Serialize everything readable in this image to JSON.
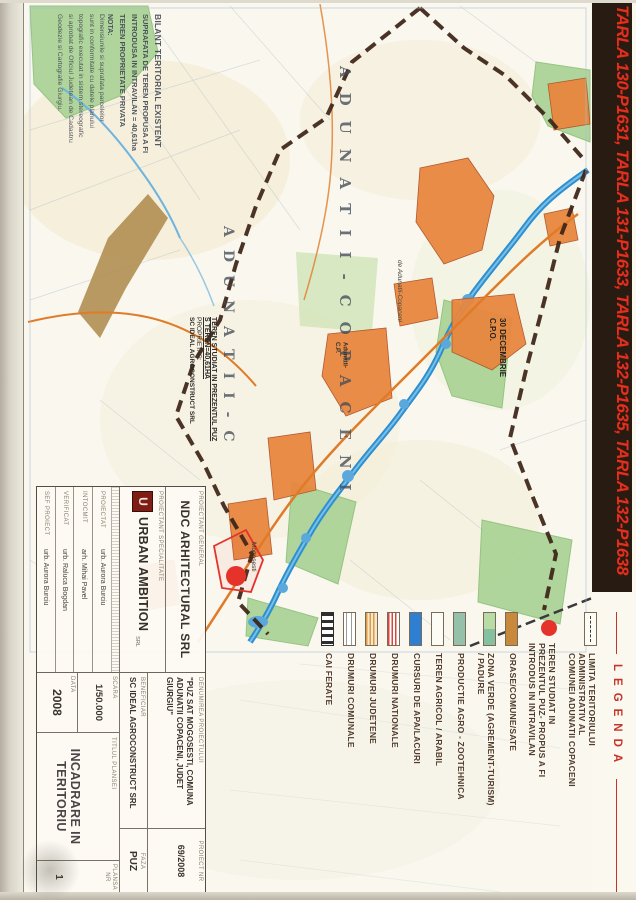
{
  "colors": {
    "banner_bg": "#281c12",
    "banner_text": "#e0301e",
    "legend_title_red": "#c5342a",
    "legend_text": "#503b2c",
    "map_paper": "#faf8ef",
    "river_blue": "#2e8fd0",
    "village_orange": "#e8873f",
    "boundary_brown": "#3c2316",
    "site_red": "#e5322a",
    "forest_green": "#a9d294"
  },
  "banner": {
    "text": "TARLA 130-P1631, TARLA 131-P1633, TARLA 132-P1635, TARLA 132-P1638"
  },
  "bilant": {
    "title": "BILANT TERITORIAL EXISTENT",
    "lines": [
      "SUPRAFATA DE TEREN PROPUSA A FI",
      "INTRODUSA IN INTRAVILAN = 40,61ha",
      "TEREN PROPRIETATE PRIVATA"
    ],
    "nota_title": "NOTA:",
    "nota_lines": [
      "Dimensiunile si suprafata parcelelor",
      "sunt in conformitate cu datele planului",
      "topografic executat in sistem stereografic",
      "si aprobat de Oficiul Judetean de Cadastru",
      "Geodezie si Cartografie Giurgiu."
    ]
  },
  "site_note": {
    "line1": "TEREN STUDIAT IN PREZENTUL PUZ",
    "line2": "S TEREN=40,61HA",
    "line3": "PROPRIETAR:",
    "line4": "SC IDEAL AGROCONSTRUCT SRL"
  },
  "map_labels": {
    "spread_name_1": "ADUNATII-COPACENI",
    "spread_name_2": "ADUNATII-C",
    "village_30dec": "30 DECEMBRIE",
    "village_30dec_sub": "C.P.O.",
    "road_label": "de Adunatii-Copaceni",
    "village_adunatii": "Adunatii-",
    "village_adunatii_sub": "C.P.",
    "village_mogosesti": "Mogosesti"
  },
  "legend": {
    "title": "LEGENDA",
    "items": [
      {
        "symbol": "administrative-boundary",
        "lines": [
          "LIMITA TERITORIULUI",
          "ADMINISTRATIV AL",
          "COMUNEI ADUNATII COPACENI"
        ]
      },
      {
        "symbol": "studied-land-circle",
        "lines": [
          "TEREN STUDIAT IN",
          "PREZENTUL PUZ- PROPUS A FI",
          "INTRODUS IN INTRAVILAN"
        ]
      },
      {
        "symbol": "built-up-area",
        "lines": [
          "ORASE/COMUNE/SATE"
        ]
      },
      {
        "symbol": "green-zone",
        "lines": [
          "ZONA VERDE (AGREMENT-TURISM)",
          "/ PADURE"
        ]
      },
      {
        "symbol": "agro-zootechnical",
        "lines": [
          "PRODUCTIE AGRO - ZOOTEHNICA"
        ]
      },
      {
        "symbol": "agricultural-land",
        "lines": [
          "TEREN AGRICOL / ARABIL"
        ]
      },
      {
        "symbol": "water-courses",
        "lines": [
          "CURSURI DE APA/LACURI"
        ]
      },
      {
        "symbol": "national-roads",
        "lines": [
          "DRUMURI NATIONALE"
        ]
      },
      {
        "symbol": "county-roads",
        "lines": [
          "DRUMURI JUDETENE"
        ]
      },
      {
        "symbol": "communal-roads",
        "lines": [
          "DRUMURI COMUNALE"
        ]
      },
      {
        "symbol": "railways",
        "lines": [
          "CAI FERATE"
        ]
      }
    ]
  },
  "title_block": {
    "proiectant_general_label": "PROIECTANT GENERAL",
    "proiectant_general": "NDC ARHITECTURAL SRL",
    "proiectant_spec_label": "PROIECTANT SPECIALITATE",
    "proiectant_spec": "URBAN AMBITION",
    "proiectant_spec_suffix": "SRL",
    "logo_letter": "U",
    "signers": [
      {
        "label": "PROIECTAT",
        "name": "urb. Aurora Burciu"
      },
      {
        "label": "INTOCMIT",
        "name": "arh. Mihai Pavel"
      },
      {
        "label": "VERIFICAT",
        "name": "urb. Raluca Bogdan"
      },
      {
        "label": "SEF PROIECT",
        "name": "urb. Aurora Burciu"
      }
    ],
    "denumire_label": "DENUMIREA PROIECTULUI",
    "denumire": "\"PUZ SAT MOGOSESTI, COMUNA ADUNATII COPACENI, JUDET GIURGIU\"",
    "beneficiar_label": "BENEFICIAR",
    "beneficiar": "SC IDEAL AGROCONSTRUCT SRL",
    "proiect_nr_label": "PROIECT NR",
    "proiect_nr": "69/2008",
    "faza_label": "FAZA",
    "faza": "PUZ",
    "scara_label": "SCARA",
    "scara": "1/50.000",
    "data_label": "DATA",
    "data": "2008",
    "titlu_label": "TITLUL PLANSEI",
    "titlu": "INCADRARE IN TERITORIU",
    "plansa_label": "PLANSA NR",
    "plansa": "1"
  }
}
